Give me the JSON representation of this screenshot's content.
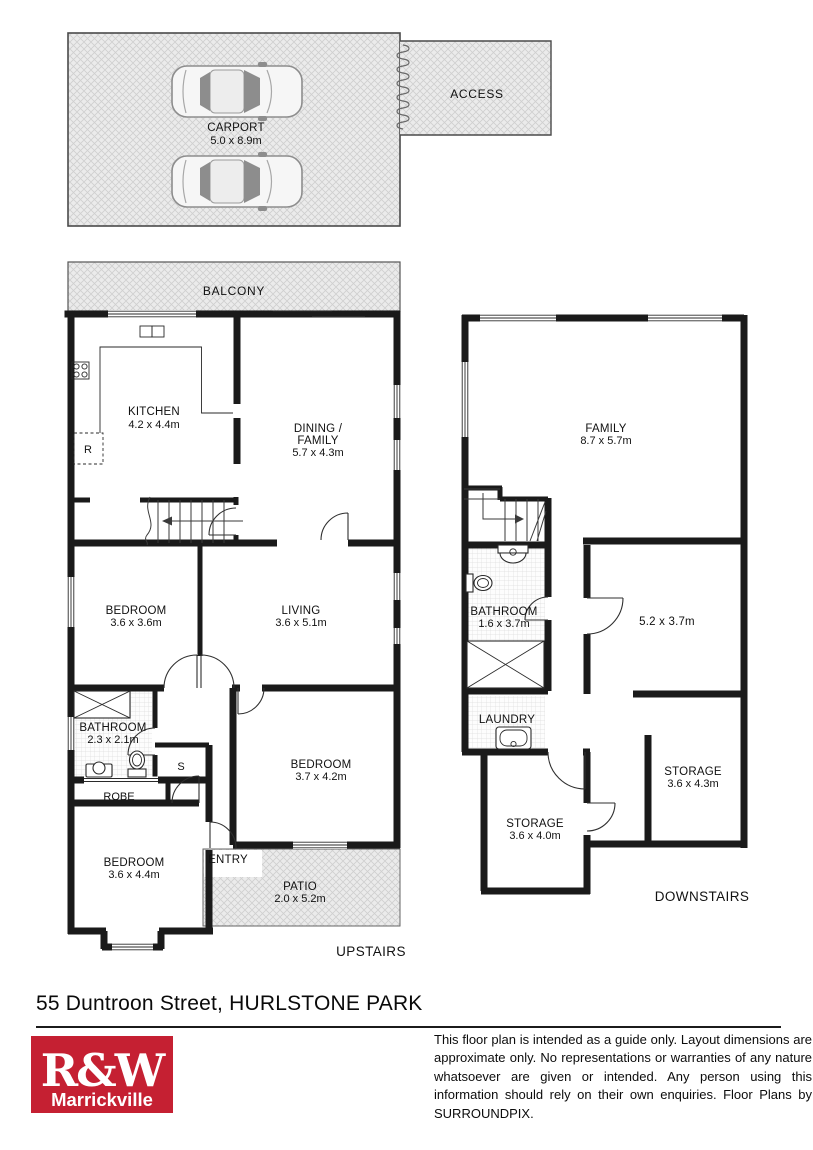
{
  "outdoor": {
    "carport": {
      "name": "CARPORT",
      "dims": "5.0 x 8.9m"
    },
    "access": {
      "name": "ACCESS"
    },
    "balcony": {
      "name": "BALCONY"
    },
    "patio": {
      "name": "PATIO",
      "dims": "2.0 x 5.2m"
    },
    "entry": {
      "name": "ENTRY"
    }
  },
  "upstairs": {
    "floor_label": "UPSTAIRS",
    "kitchen": {
      "name": "KITCHEN",
      "dims": "4.2 x 4.4m"
    },
    "dining_family": {
      "line1": "DINING /",
      "line2": "FAMILY",
      "dims": "5.7 x 4.3m"
    },
    "bedroom_front": {
      "name": "BEDROOM",
      "dims": "3.6 x 3.6m"
    },
    "living": {
      "name": "LIVING",
      "dims": "3.6 x 5.1m"
    },
    "bathroom": {
      "name": "BATHROOM",
      "dims": "2.3 x 2.1m"
    },
    "robe": {
      "name": "ROBE"
    },
    "bedroom_mid": {
      "name": "BEDROOM",
      "dims": "3.7 x 4.2m"
    },
    "bedroom_rear": {
      "name": "BEDROOM",
      "dims": "3.6 x 4.4m"
    },
    "fridge_symbol": "R",
    "cupboard_symbol": "S"
  },
  "downstairs": {
    "floor_label": "DOWNSTAIRS",
    "family": {
      "name": "FAMILY",
      "dims": "8.7 x 5.7m"
    },
    "bathroom": {
      "name": "BATHROOM",
      "dims": "1.6 x 3.7m"
    },
    "rumpus": {
      "dims": "5.2 x 3.7m"
    },
    "laundry": {
      "name": "LAUNDRY"
    },
    "storage_left": {
      "name": "STORAGE",
      "dims": "3.6 x 4.0m"
    },
    "storage_right": {
      "name": "STORAGE",
      "dims": "3.6 x 4.3m"
    }
  },
  "footer": {
    "address": "55 Duntroon Street, HURLSTONE PARK",
    "logo": {
      "line1": "R&W",
      "line2": "Marrickville",
      "color": "#c52032"
    },
    "disclaimer": "This floor plan is intended as a guide only. Layout dimensions are approximate only. No representations or warranties of any nature whatsoever are given or intended. Any person using this information should rely on their own enquiries. Floor Plans by  SURROUNDPIX."
  }
}
